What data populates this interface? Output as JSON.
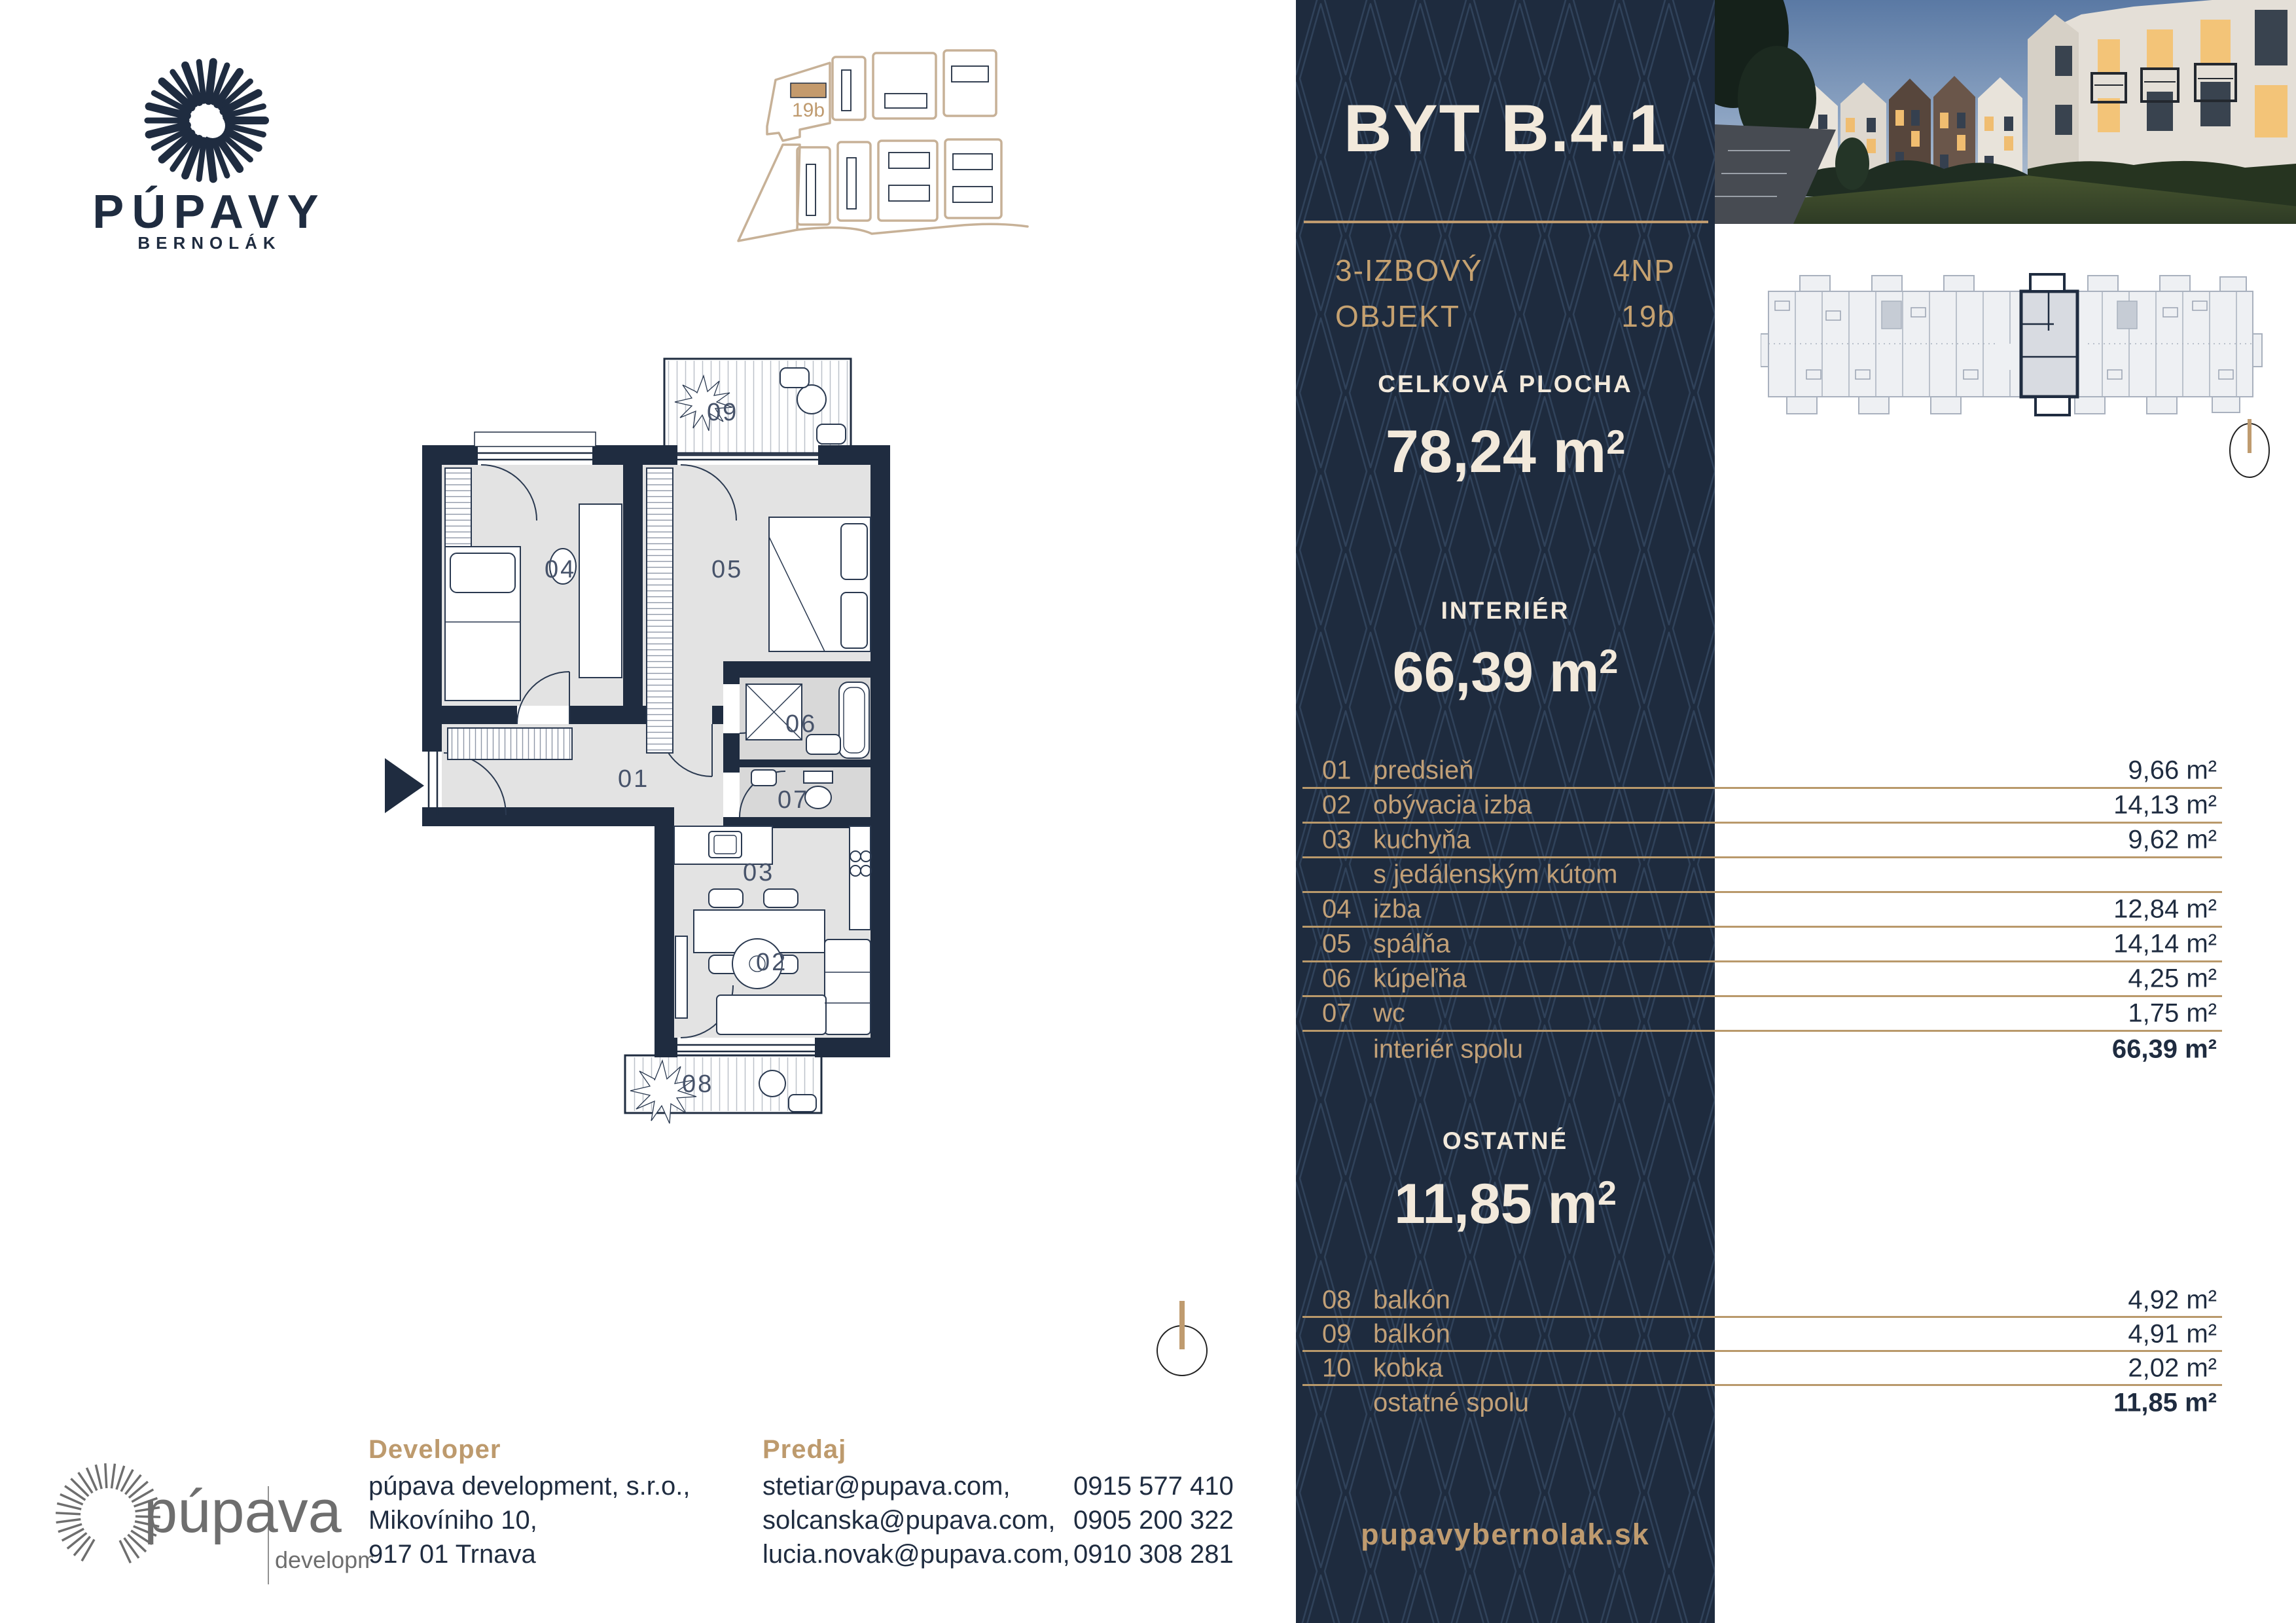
{
  "brand": {
    "name": "PÚPAVY",
    "subtitle": "BERNOLÁK"
  },
  "site_plan": {
    "highlight_label": "19b"
  },
  "panel": {
    "title": "BYT B.4.1",
    "meta": {
      "rooms_type": "3-IZBOVÝ",
      "object_label": "OBJEKT",
      "floor": "4NP",
      "building": "19b"
    },
    "total": {
      "label": "CELKOVÁ PLOCHA",
      "value": "78,24",
      "unit": "m",
      "sup": "2"
    },
    "interior": {
      "label": "INTERIÉR",
      "value": "66,39",
      "unit": "m",
      "sup": "2"
    },
    "other": {
      "label": "OSTATNÉ",
      "value": "11,85",
      "unit": "m",
      "sup": "2"
    },
    "website": "pupavybernolak.sk"
  },
  "interior_table": {
    "rows": [
      {
        "num": "01",
        "name": "predsieň",
        "value": "9,66 m²"
      },
      {
        "num": "02",
        "name": "obývacia izba",
        "value": "14,13 m²"
      },
      {
        "num": "03",
        "name": "kuchyňa",
        "value": "9,62 m²"
      },
      {
        "num": "",
        "name": "s jedálenským kútom",
        "value": ""
      },
      {
        "num": "04",
        "name": "izba",
        "value": "12,84 m²"
      },
      {
        "num": "05",
        "name": "spálňa",
        "value": "14,14 m²"
      },
      {
        "num": "06",
        "name": "kúpeľňa",
        "value": "4,25 m²"
      },
      {
        "num": "07",
        "name": "wc",
        "value": "1,75 m²"
      },
      {
        "num": "",
        "name": "interiér spolu",
        "value": "66,39 m²"
      }
    ]
  },
  "other_table": {
    "rows": [
      {
        "num": "08",
        "name": "balkón",
        "value": "4,92 m²"
      },
      {
        "num": "09",
        "name": "balkón",
        "value": "4,91 m²"
      },
      {
        "num": "10",
        "name": "kobka",
        "value": "2,02 m²"
      },
      {
        "num": "",
        "name": "ostatné spolu",
        "value": "11,85 m²"
      }
    ]
  },
  "floor_plan": {
    "r01": "01",
    "r02": "02",
    "r03": "03",
    "r04": "04",
    "r05": "05",
    "r06": "06",
    "r07": "07",
    "r08": "08",
    "r09": "09"
  },
  "footer": {
    "developer": {
      "heading": "Developer",
      "lines": [
        "púpava development, s.r.o.,",
        "Mikovíniho 10,",
        "917 01 Trnava"
      ]
    },
    "sales": {
      "heading": "Predaj",
      "contacts": [
        {
          "email": "stetiar@pupava.com,",
          "phone": "0915 577 410"
        },
        {
          "email": "solcanska@pupava.com,",
          "phone": "0905 200 322"
        },
        {
          "email": "lucia.novak@pupava.com,",
          "phone": "0910 308 281"
        }
      ]
    },
    "dev_logo": {
      "name": "púpava",
      "sub": "development"
    }
  },
  "colors": {
    "navy": "#1e2b3e",
    "gold": "#bf9b6f",
    "cream": "#f2e9db",
    "room_gray": "#e3e3e3"
  }
}
